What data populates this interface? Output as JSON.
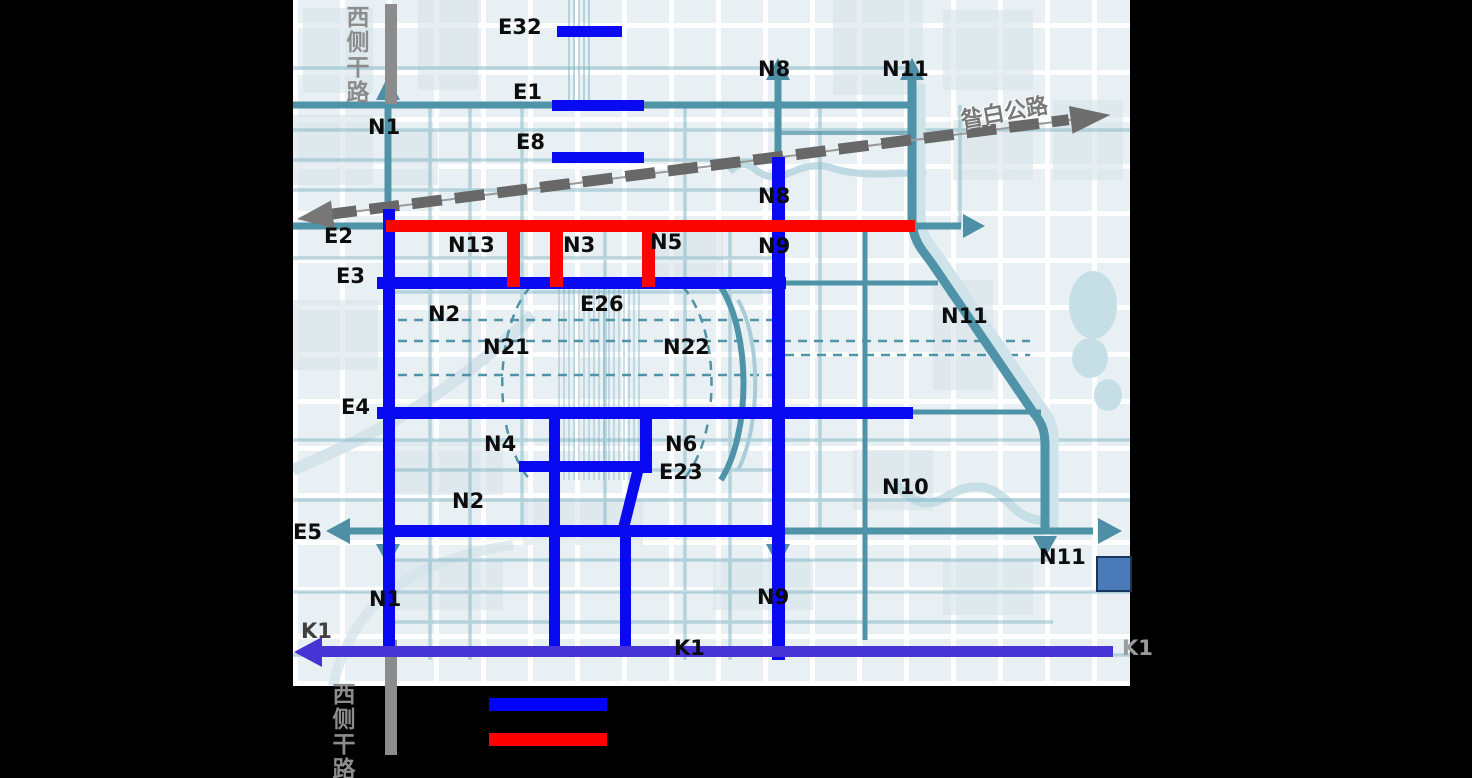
{
  "page": {
    "width": 1472,
    "height": 778,
    "background": "#000000"
  },
  "map": {
    "area": {
      "x": 293,
      "y": 0,
      "width": 837,
      "height": 686
    },
    "base_colors": {
      "background": "#e9f0f3",
      "block": "#d8e5ea",
      "road_teal": "#4f93a8",
      "road_teal_light": "#a9cdd8"
    },
    "overlay_colors": {
      "planned_blue": "#0a0af2",
      "highlight_red": "#fb0503",
      "k1_purple": "#4834d4",
      "trunk_gray": "#8c8c8c"
    },
    "highway": {
      "label": "昝白公路",
      "style": "dashed-gray-double-arrow"
    },
    "west_trunk_road": {
      "label_top": "西侧干路",
      "label_bottom": "西侧干路",
      "color": "#8c8c8c"
    },
    "labels": [
      {
        "id": "e32",
        "text": "E32",
        "x": 498,
        "y": 15,
        "style": "road"
      },
      {
        "id": "e1",
        "text": "E1",
        "x": 513,
        "y": 80,
        "style": "road"
      },
      {
        "id": "e8",
        "text": "E8",
        "x": 516,
        "y": 130,
        "style": "road"
      },
      {
        "id": "n1-top",
        "text": "N1",
        "x": 368,
        "y": 115,
        "style": "road"
      },
      {
        "id": "n8-top",
        "text": "N8",
        "x": 758,
        "y": 57,
        "style": "road"
      },
      {
        "id": "n11-top",
        "text": "N11",
        "x": 882,
        "y": 57,
        "style": "road"
      },
      {
        "id": "e2",
        "text": "E2",
        "x": 324,
        "y": 224,
        "style": "road"
      },
      {
        "id": "n13",
        "text": "N13",
        "x": 448,
        "y": 233,
        "style": "road"
      },
      {
        "id": "n3",
        "text": "N3",
        "x": 563,
        "y": 233,
        "style": "road"
      },
      {
        "id": "n5",
        "text": "N5",
        "x": 650,
        "y": 230,
        "style": "road"
      },
      {
        "id": "n8-mid",
        "text": "N8",
        "x": 758,
        "y": 184,
        "style": "road"
      },
      {
        "id": "n9-mid",
        "text": "N9",
        "x": 758,
        "y": 234,
        "style": "road"
      },
      {
        "id": "e3",
        "text": "E3",
        "x": 336,
        "y": 264,
        "style": "road"
      },
      {
        "id": "n2-upper",
        "text": "N2",
        "x": 428,
        "y": 302,
        "style": "road"
      },
      {
        "id": "n21",
        "text": "N21",
        "x": 483,
        "y": 335,
        "style": "road"
      },
      {
        "id": "e26",
        "text": "E26",
        "x": 580,
        "y": 292,
        "style": "road"
      },
      {
        "id": "n22",
        "text": "N22",
        "x": 663,
        "y": 335,
        "style": "road"
      },
      {
        "id": "n11-mid",
        "text": "N11",
        "x": 941,
        "y": 304,
        "style": "road"
      },
      {
        "id": "e4",
        "text": "E4",
        "x": 341,
        "y": 395,
        "style": "road"
      },
      {
        "id": "n4",
        "text": "N4",
        "x": 484,
        "y": 432,
        "style": "road"
      },
      {
        "id": "n6",
        "text": "N6",
        "x": 665,
        "y": 432,
        "style": "road"
      },
      {
        "id": "e23",
        "text": "E23",
        "x": 659,
        "y": 460,
        "style": "road"
      },
      {
        "id": "n2-lower",
        "text": "N2",
        "x": 452,
        "y": 489,
        "style": "road"
      },
      {
        "id": "n10",
        "text": "N10",
        "x": 882,
        "y": 475,
        "style": "road"
      },
      {
        "id": "e5",
        "text": "E5",
        "x": 293,
        "y": 520,
        "style": "road"
      },
      {
        "id": "n1-bottom",
        "text": "N1",
        "x": 369,
        "y": 587,
        "style": "road"
      },
      {
        "id": "n9-bottom",
        "text": "N9",
        "x": 757,
        "y": 585,
        "style": "road"
      },
      {
        "id": "n11-bottom",
        "text": "N11",
        "x": 1039,
        "y": 545,
        "style": "road"
      },
      {
        "id": "k1-left",
        "text": "K1",
        "x": 301,
        "y": 619,
        "style": "gray-dark"
      },
      {
        "id": "k1-mid",
        "text": "K1",
        "x": 674,
        "y": 636,
        "style": "road"
      },
      {
        "id": "k1-right",
        "text": "K1",
        "x": 1122,
        "y": 636,
        "style": "gray-light"
      },
      {
        "id": "west-top",
        "text": "西侧干路",
        "x": 342,
        "y": 5,
        "style": "v-gray"
      },
      {
        "id": "west-bottom",
        "text": "西侧干路",
        "x": 328,
        "y": 682,
        "style": "v-gray"
      },
      {
        "id": "highway",
        "text": "昝白公路",
        "x": 960,
        "y": 95,
        "style": "hw-lbl"
      }
    ]
  },
  "legend": {
    "items": [
      {
        "name": "blue-planned-road",
        "color": "#0000ff"
      },
      {
        "name": "red-highlight-road",
        "color": "#ff0000"
      }
    ]
  }
}
